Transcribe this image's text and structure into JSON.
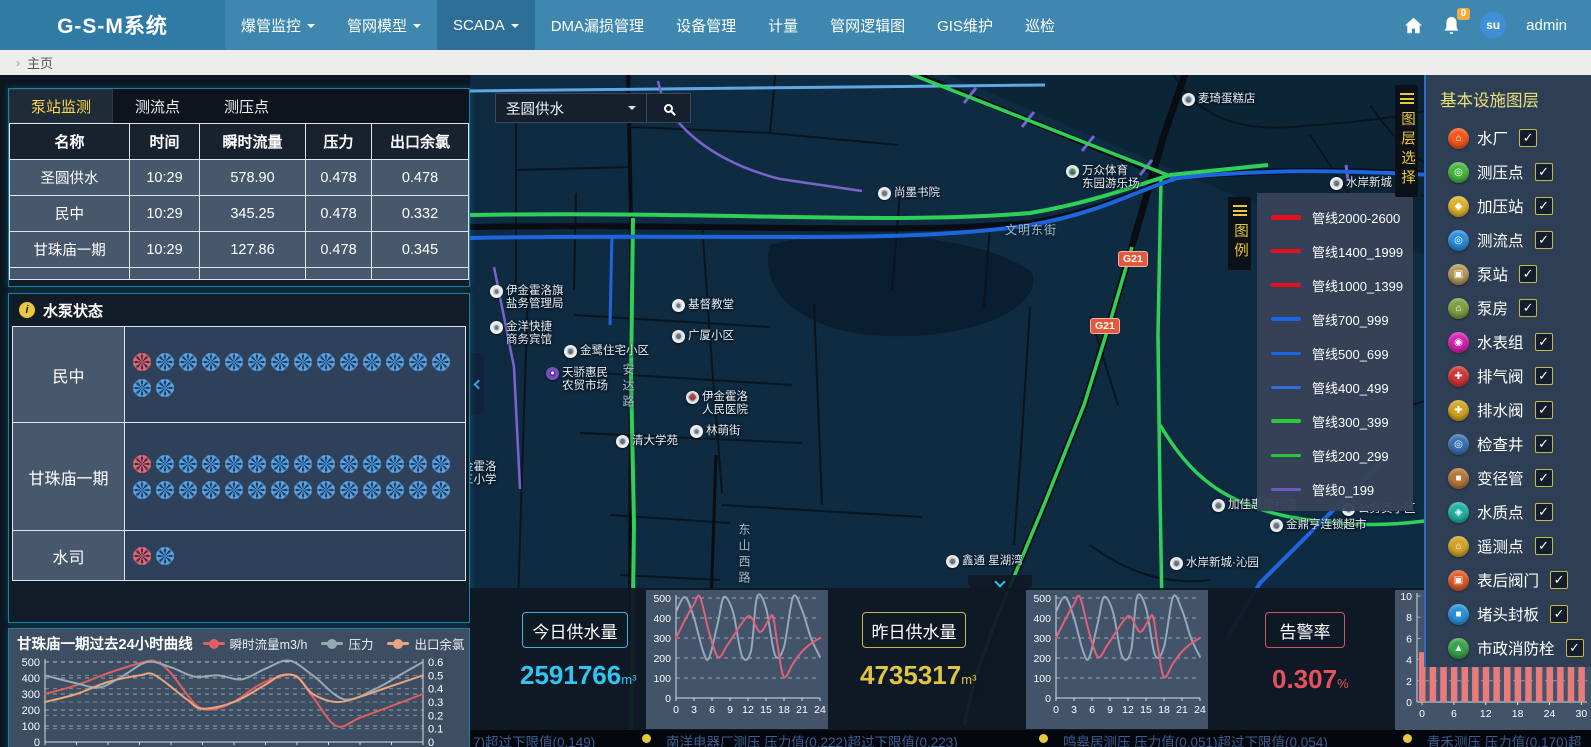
{
  "colors": {
    "nav_blue": "#3e88b0",
    "accent_cyan": "#2fc7f2",
    "accent_yellow": "#e0c53e",
    "alarm_red": "#e8505e",
    "tab_active_text": "#ffd84d",
    "pipe_green": "#2fd058",
    "pipe_blue": "#1e66e0",
    "pipe_red": "#e8101e",
    "pipe_purple": "#6f5bbf"
  },
  "nav": {
    "brand": "G-S-M系统",
    "badge": "0",
    "avatar_text": "su",
    "user": "admin",
    "items": [
      {
        "label": "爆管监控",
        "caret": true,
        "active": false
      },
      {
        "label": "管网模型",
        "caret": true,
        "active": false
      },
      {
        "label": "SCADA",
        "caret": true,
        "active": true
      },
      {
        "label": "DMA漏损管理",
        "caret": false,
        "active": false
      },
      {
        "label": "设备管理",
        "caret": false,
        "active": false
      },
      {
        "label": "计量",
        "caret": false,
        "active": false
      },
      {
        "label": "管网逻辑图",
        "caret": false,
        "active": false
      },
      {
        "label": "GIS维护",
        "caret": false,
        "active": false
      },
      {
        "label": "巡检",
        "caret": false,
        "active": false
      }
    ]
  },
  "breadcrumb": {
    "page": "主页"
  },
  "monitor": {
    "tabs": [
      "泵站监测",
      "测流点",
      "测压点"
    ],
    "active_tab": 0,
    "columns": [
      "名称",
      "时间",
      "瞬时流量",
      "压力",
      "出口余氯"
    ],
    "rows": [
      {
        "name": "圣圆供水",
        "time": "10:29",
        "flow": "578.90",
        "pressure": "0.478",
        "chlorine": "0.478"
      },
      {
        "name": "民中",
        "time": "10:29",
        "flow": "345.25",
        "pressure": "0.478",
        "chlorine": "0.332"
      },
      {
        "name": "甘珠庙一期",
        "time": "10:29",
        "flow": "127.86",
        "pressure": "0.478",
        "chlorine": "0.345"
      }
    ]
  },
  "pump_status": {
    "title": "水泵状态",
    "rows": [
      {
        "name": "民中",
        "red": 1,
        "blue": 15
      },
      {
        "name": "甘珠庙一期",
        "red": 1,
        "blue": 27
      },
      {
        "name": "水司",
        "red": 1,
        "blue": 1
      }
    ]
  },
  "map": {
    "search": {
      "value": "圣圆供水"
    },
    "layer_toggle": "图层选择",
    "legend_toggle": "图例",
    "road_badges": [
      {
        "text": "G21",
        "x": 648,
        "y": 176
      },
      {
        "text": "G21",
        "x": 620,
        "y": 243
      }
    ],
    "legend": {
      "items": [
        {
          "label": "管线2000-2600",
          "color": "#e8101e",
          "weight": 5
        },
        {
          "label": "管线1400_1999",
          "color": "#e8101e",
          "weight": 4
        },
        {
          "label": "管线1000_1399",
          "color": "#e8101e",
          "weight": 4
        },
        {
          "label": "管线700_999",
          "color": "#1f62e8",
          "weight": 4
        },
        {
          "label": "管线500_699",
          "color": "#1f62e8",
          "weight": 3
        },
        {
          "label": "管线400_499",
          "color": "#2e6ee0",
          "weight": 3
        },
        {
          "label": "管线300_399",
          "color": "#28c838",
          "weight": 4
        },
        {
          "label": "管线200_299",
          "color": "#28c838",
          "weight": 3
        },
        {
          "label": "管线0_199",
          "color": "#6f5bbf",
          "weight": 3
        }
      ]
    },
    "labels": [
      {
        "text": "麦琦蛋糕店",
        "x": 712,
        "y": 18,
        "icon": "shop"
      },
      {
        "text": "万众体育",
        "text2": "东园游乐场",
        "x": 596,
        "y": 90,
        "icon": "tree"
      },
      {
        "text": "水岸新城",
        "x": 860,
        "y": 102,
        "icon": "bld"
      },
      {
        "text": "尚墨书院",
        "x": 408,
        "y": 112,
        "icon": "bld"
      },
      {
        "text": "伊金霍洛旗",
        "text2": "盐务管理局",
        "x": 20,
        "y": 210,
        "icon": "pin"
      },
      {
        "text": "金洋快捷",
        "text2": "商务宾馆",
        "x": 20,
        "y": 246,
        "icon": "pin"
      },
      {
        "text": "金鹭住宅小区",
        "x": 94,
        "y": 270,
        "icon": "bld"
      },
      {
        "text": "天骄惠民",
        "text2": "农贸市场",
        "x": 76,
        "y": 292,
        "icon": "market"
      },
      {
        "text": "基督教堂",
        "x": 202,
        "y": 224,
        "icon": "dot"
      },
      {
        "text": "广厦小区",
        "x": 202,
        "y": 255,
        "icon": "bld"
      },
      {
        "text": "伊金霍洛",
        "text2": "人民医院",
        "x": 216,
        "y": 316,
        "icon": "hosp"
      },
      {
        "text": "林萌街",
        "x": 220,
        "y": 350,
        "icon": "dot"
      },
      {
        "text": "清大学苑",
        "x": 146,
        "y": 360,
        "icon": "bld"
      },
      {
        "text": "金霍洛",
        "text2": "三小学",
        "x": -8,
        "y": 386,
        "icon": null
      },
      {
        "text": "鑫通 星湖湾",
        "x": 476,
        "y": 480,
        "icon": "bld"
      },
      {
        "text": "加佳惠便利店",
        "x": 742,
        "y": 424,
        "icon": "shop"
      },
      {
        "text": "公务员小区",
        "x": 872,
        "y": 428,
        "icon": "bld"
      },
      {
        "text": "金鼎亨连锁超市",
        "x": 800,
        "y": 444,
        "icon": "shop"
      },
      {
        "text": "水岸新城·沁园",
        "x": 700,
        "y": 482,
        "icon": "bld"
      }
    ],
    "streets": [
      {
        "text": "文明东街",
        "x": 535,
        "y": 146,
        "vertical": false
      },
      {
        "text": "安达路",
        "x": 150,
        "y": 288,
        "vertical": true
      },
      {
        "text": "东山西路",
        "x": 266,
        "y": 448,
        "vertical": true
      }
    ]
  },
  "layers_panel": {
    "title": "基本设施图层",
    "items": [
      {
        "label": "水厂",
        "color": "#f4581e",
        "checked": true
      },
      {
        "label": "测压点",
        "color": "#48b840",
        "checked": true
      },
      {
        "label": "加压站",
        "color": "#e0b22e",
        "checked": true
      },
      {
        "label": "测流点",
        "color": "#2b8de0",
        "checked": true
      },
      {
        "label": "泵站",
        "color": "#b49a58",
        "checked": true
      },
      {
        "label": "泵房",
        "color": "#7fa040",
        "checked": true
      },
      {
        "label": "水表组",
        "color": "#d822b2",
        "checked": true
      },
      {
        "label": "排气阀",
        "color": "#d23434",
        "checked": true
      },
      {
        "label": "排水阀",
        "color": "#d2a422",
        "checked": true
      },
      {
        "label": "检查井",
        "color": "#3a72b4",
        "checked": true
      },
      {
        "label": "变径管",
        "color": "#b4783a",
        "checked": true
      },
      {
        "label": "水质点",
        "color": "#22b2a2",
        "checked": true
      },
      {
        "label": "遥测点",
        "color": "#d2a42c",
        "checked": true
      },
      {
        "label": "表后阀门",
        "color": "#e05c2a",
        "checked": true
      },
      {
        "label": "堵头封板",
        "color": "#2b92da",
        "checked": true
      },
      {
        "label": "市政消防栓",
        "color": "#3aa44a",
        "checked": true
      }
    ]
  },
  "bottom": {
    "today_label": "今日供水量",
    "today_value": "2591766",
    "today_unit": "m³",
    "yesterday_label": "昨日供水量",
    "yesterday_value": "4735317",
    "yesterday_unit": "m³",
    "alarm_label": "告警率",
    "alarm_value": "0.307",
    "alarm_unit": "%"
  },
  "ticker": {
    "items": [
      "7)超过下限值(0.149)",
      "南洋电器厂测压  压力值(0.222)超过下限值(0.223)",
      "鸣皋居测压  压力值(0.051)超过下限值(0.054)",
      "青禾测压  压力值(0.170)超"
    ]
  },
  "chart_data": [
    {
      "id": "pump_24h",
      "type": "line",
      "title": "甘珠庙一期过去24小时曲线",
      "x": {
        "min": 0,
        "max": 24
      },
      "left_axis": {
        "min": 0,
        "max": 500,
        "ticks": [
          0,
          100,
          200,
          300,
          400,
          500
        ]
      },
      "right_axis": {
        "min": 0,
        "max": 0.6,
        "ticks": [
          0,
          0.1,
          0.2,
          0.3,
          0.4,
          0.5,
          0.6
        ]
      },
      "series": [
        {
          "name": "瞬时流量m3/h",
          "color": "#e05f62",
          "axis": "left",
          "points": [
            [
              0,
              300
            ],
            [
              2,
              355
            ],
            [
              4,
              430
            ],
            [
              6,
              492
            ],
            [
              7,
              505
            ],
            [
              8,
              430
            ],
            [
              9.5,
              240
            ],
            [
              10.5,
              202
            ],
            [
              12,
              252
            ],
            [
              13.5,
              352
            ],
            [
              15,
              412
            ],
            [
              16,
              405
            ],
            [
              17,
              282
            ],
            [
              18.5,
              100
            ],
            [
              20,
              152
            ],
            [
              22,
              225
            ],
            [
              24,
              300
            ]
          ]
        },
        {
          "name": "压力",
          "color": "#94abb6",
          "axis": "right",
          "points": [
            [
              0,
              0.5
            ],
            [
              2,
              0.44
            ],
            [
              3.5,
              0.41
            ],
            [
              5,
              0.5
            ],
            [
              6.5,
              0.6
            ],
            [
              8,
              0.56
            ],
            [
              9.5,
              0.49
            ],
            [
              11,
              0.5
            ],
            [
              12.5,
              0.47
            ],
            [
              14,
              0.55
            ],
            [
              15.5,
              0.61
            ],
            [
              17,
              0.5
            ],
            [
              19,
              0.32
            ],
            [
              21,
              0.4
            ],
            [
              22.5,
              0.5
            ],
            [
              24,
              0.6
            ]
          ]
        },
        {
          "name": "出口余氯",
          "color": "#e8a57f",
          "axis": "right",
          "points": [
            [
              0,
              0.3
            ],
            [
              2,
              0.36
            ],
            [
              4,
              0.45
            ],
            [
              6,
              0.5
            ],
            [
              7,
              0.5
            ],
            [
              9,
              0.32
            ],
            [
              10,
              0.25
            ],
            [
              12,
              0.3
            ],
            [
              14,
              0.43
            ],
            [
              15,
              0.5
            ],
            [
              16,
              0.49
            ],
            [
              17,
              0.36
            ],
            [
              18.5,
              0.3
            ],
            [
              20,
              0.34
            ],
            [
              22,
              0.42
            ],
            [
              24,
              0.5
            ]
          ]
        }
      ]
    },
    {
      "id": "today_curve",
      "type": "line",
      "x": {
        "min": 0,
        "max": 24
      },
      "x_ticks": [
        0,
        3,
        6,
        9,
        12,
        15,
        18,
        21,
        24
      ],
      "left_axis": {
        "min": 0,
        "max": 500,
        "ticks": [
          0,
          100,
          200,
          300,
          400,
          500
        ]
      },
      "series": [
        {
          "name": "压力",
          "color": "#93a9ba",
          "axis": "left",
          "points": [
            [
              0,
              430
            ],
            [
              1.5,
              505
            ],
            [
              3,
              400
            ],
            [
              4.5,
              235
            ],
            [
              5.5,
              200
            ],
            [
              7,
              380
            ],
            [
              8,
              505
            ],
            [
              9.5,
              430
            ],
            [
              11,
              210
            ],
            [
              12.5,
              235
            ],
            [
              13.5,
              505
            ],
            [
              15,
              450
            ],
            [
              16.5,
              215
            ],
            [
              18,
              255
            ],
            [
              19.5,
              505
            ],
            [
              21,
              440
            ],
            [
              22.5,
              300
            ],
            [
              24,
              205
            ]
          ]
        },
        {
          "name": "流量",
          "color": "#e0607a",
          "axis": "left",
          "points": [
            [
              0,
              300
            ],
            [
              1.5,
              390
            ],
            [
              3,
              470
            ],
            [
              4,
              505
            ],
            [
              5.5,
              330
            ],
            [
              7,
              205
            ],
            [
              8.5,
              262
            ],
            [
              10,
              330
            ],
            [
              11.5,
              395
            ],
            [
              12.5,
              405
            ],
            [
              14,
              330
            ],
            [
              15.5,
              392
            ],
            [
              16.2,
              405
            ],
            [
              17,
              250
            ],
            [
              18,
              105
            ],
            [
              19.5,
              172
            ],
            [
              21,
              232
            ],
            [
              22.5,
              272
            ],
            [
              24,
              300
            ]
          ]
        }
      ]
    },
    {
      "id": "yesterday_curve",
      "type": "line",
      "x": {
        "min": 0,
        "max": 24
      },
      "x_ticks": [
        0,
        3,
        6,
        9,
        12,
        15,
        18,
        21,
        24
      ],
      "left_axis": {
        "min": 0,
        "max": 500,
        "ticks": [
          0,
          100,
          200,
          300,
          400,
          500
        ]
      },
      "series": [
        {
          "name": "压力",
          "color": "#93a9ba",
          "axis": "left",
          "points": [
            [
              0,
              430
            ],
            [
              1.5,
              505
            ],
            [
              3,
              400
            ],
            [
              4.5,
              235
            ],
            [
              5.5,
              200
            ],
            [
              7,
              380
            ],
            [
              8,
              505
            ],
            [
              9.5,
              430
            ],
            [
              11,
              210
            ],
            [
              12.5,
              235
            ],
            [
              13.5,
              505
            ],
            [
              15,
              450
            ],
            [
              16.5,
              215
            ],
            [
              18,
              255
            ],
            [
              19.5,
              505
            ],
            [
              21,
              440
            ],
            [
              22.5,
              300
            ],
            [
              24,
              205
            ]
          ]
        },
        {
          "name": "流量",
          "color": "#e0607a",
          "axis": "left",
          "points": [
            [
              0,
              300
            ],
            [
              1.5,
              390
            ],
            [
              3,
              470
            ],
            [
              4,
              505
            ],
            [
              5.5,
              330
            ],
            [
              7,
              205
            ],
            [
              8.5,
              262
            ],
            [
              10,
              330
            ],
            [
              11.5,
              395
            ],
            [
              12.5,
              405
            ],
            [
              14,
              330
            ],
            [
              15.5,
              392
            ],
            [
              16.2,
              405
            ],
            [
              17,
              250
            ],
            [
              18,
              105
            ],
            [
              19.5,
              172
            ],
            [
              21,
              232
            ],
            [
              22.5,
              272
            ],
            [
              24,
              300
            ]
          ]
        }
      ]
    },
    {
      "id": "alarm_bars",
      "type": "bar",
      "color": "#e87c7c",
      "y_axis": {
        "min": 0,
        "max": 10,
        "ticks": [
          0,
          2,
          4,
          6,
          8,
          10
        ]
      },
      "x_ticks": [
        0,
        6,
        12,
        18,
        24,
        30
      ],
      "bar_hours": [
        0,
        2,
        4,
        6,
        8,
        10,
        12,
        14,
        16,
        18,
        20,
        22,
        24,
        26,
        28,
        30
      ],
      "values": [
        4.7,
        4.6,
        4.7,
        4.5,
        4.7,
        4.6,
        4.7,
        4.7,
        4.6,
        4.7,
        4.5,
        4.7,
        4.6,
        4.7,
        4.7,
        4.6
      ]
    }
  ]
}
